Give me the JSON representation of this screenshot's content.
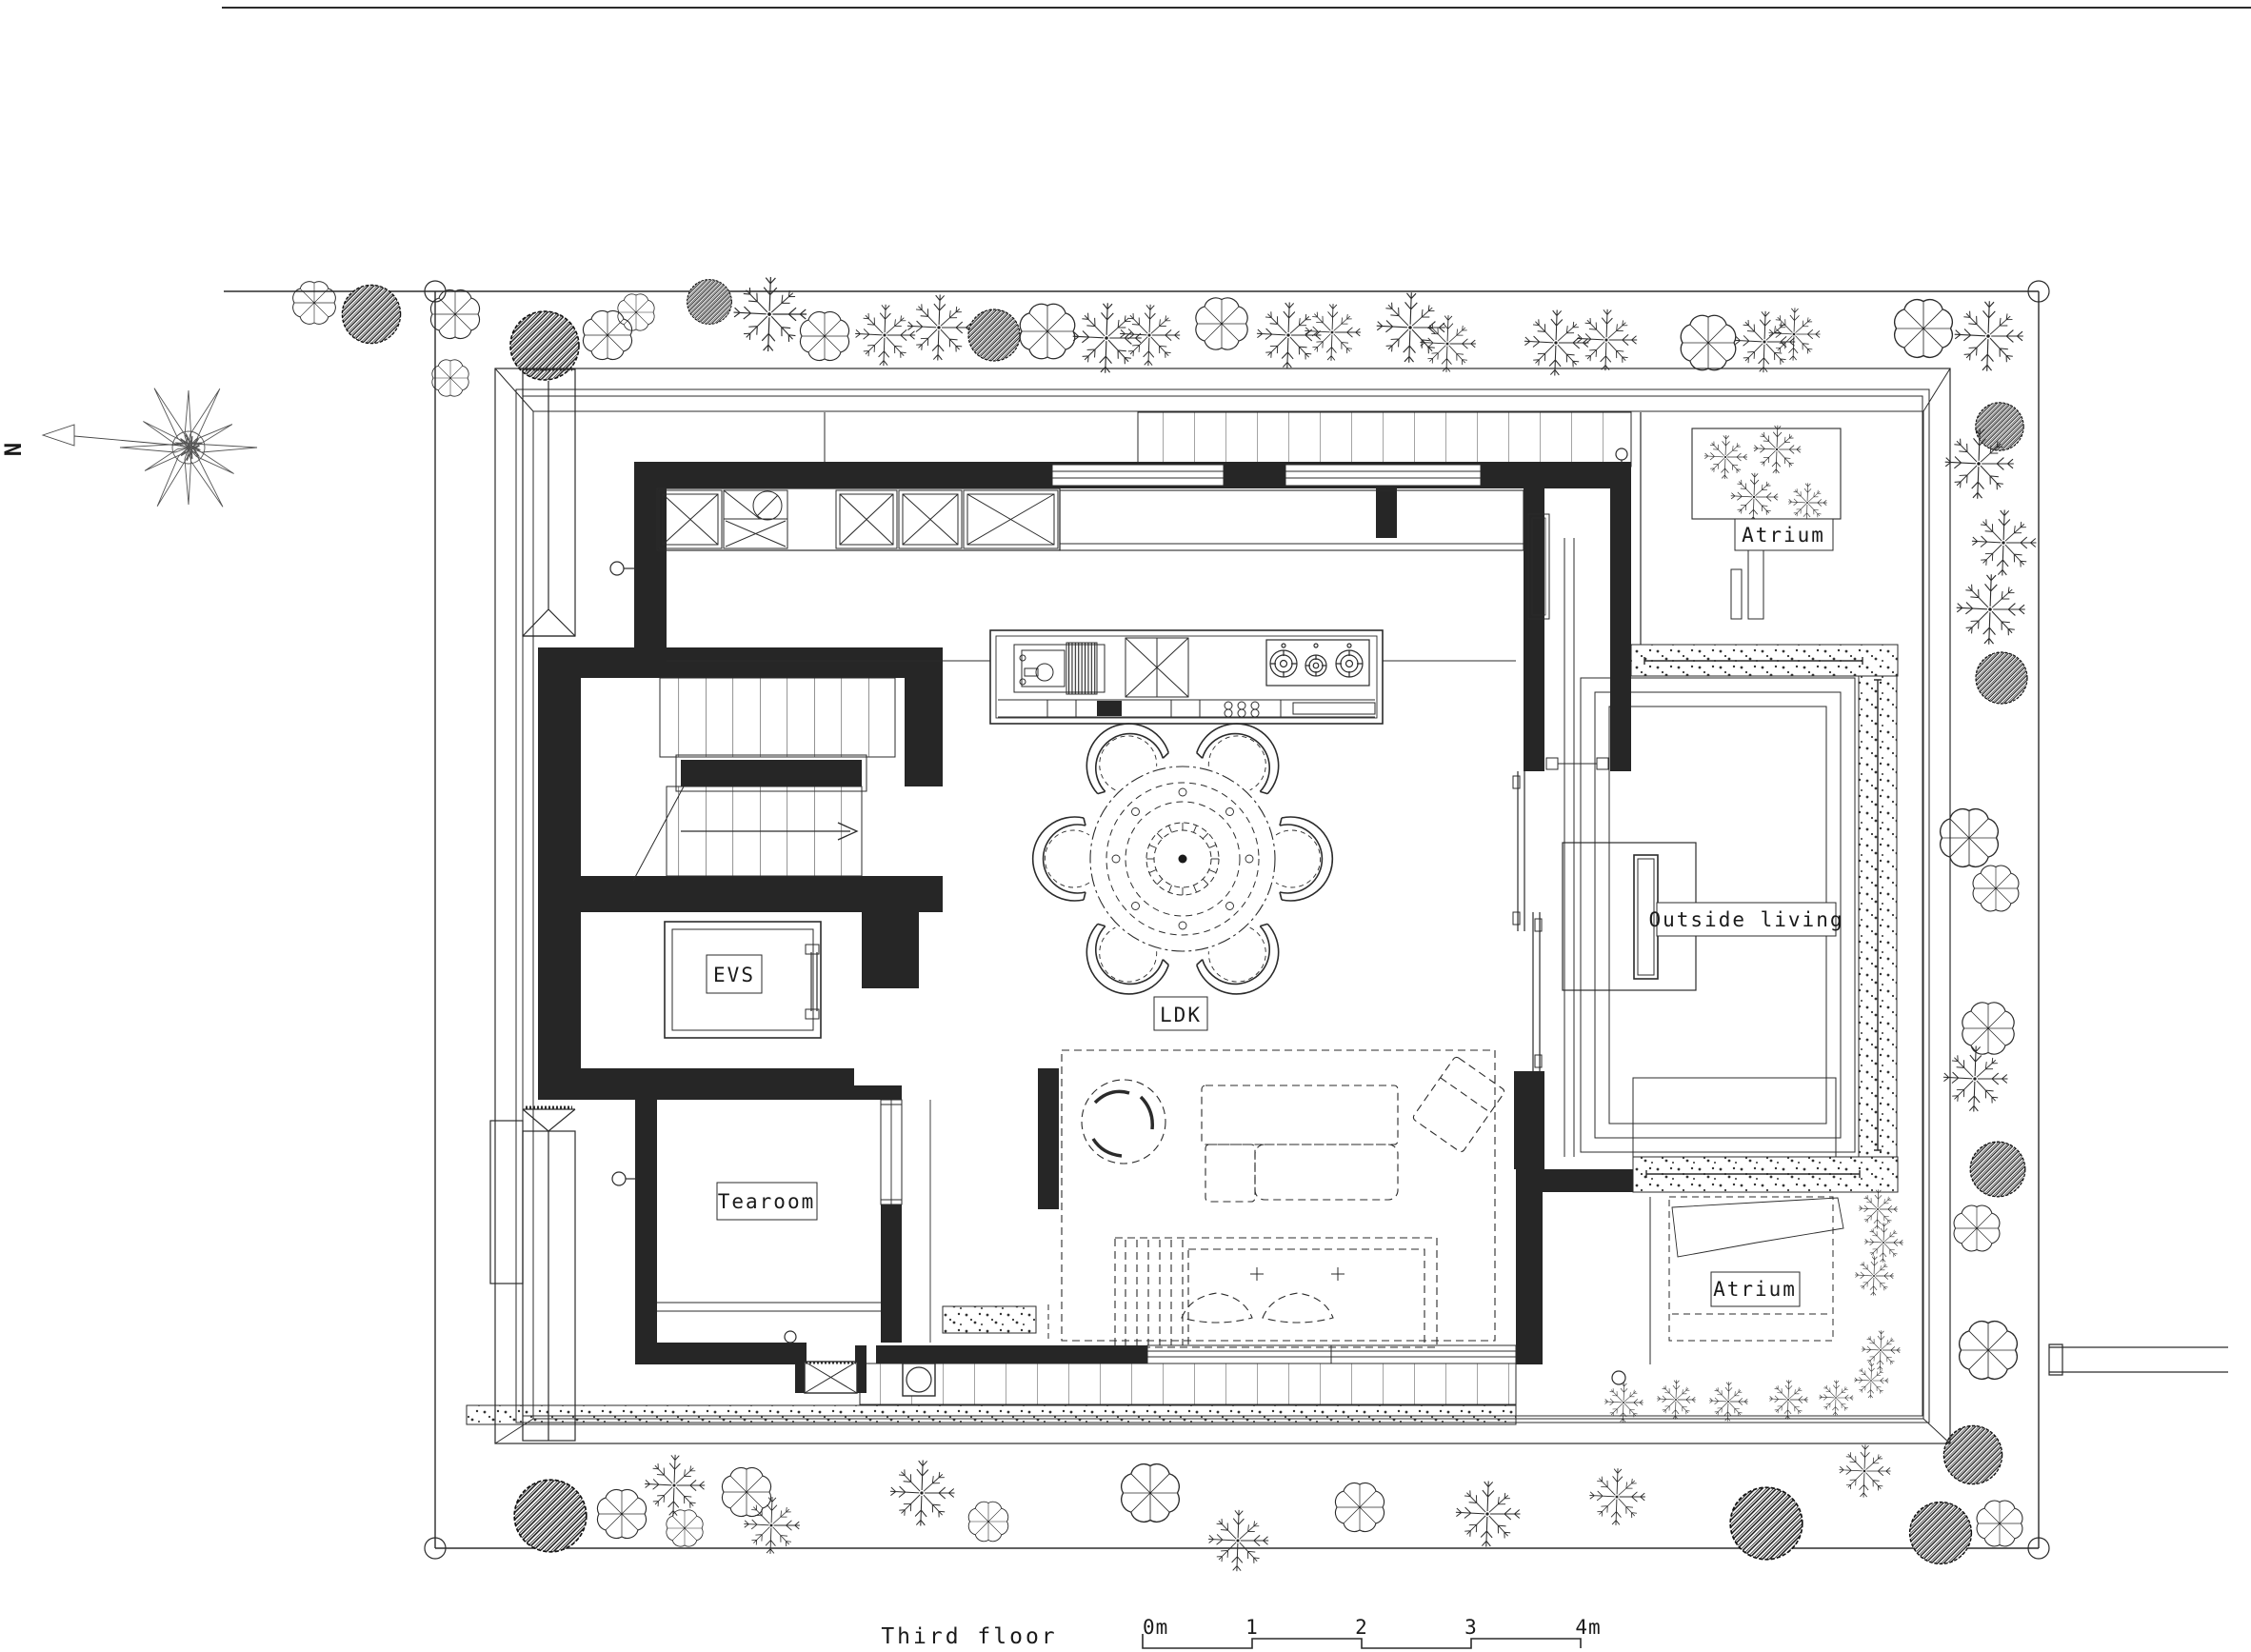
{
  "title": {
    "text": "Third floor"
  },
  "north": {
    "label": "N"
  },
  "rooms": {
    "ldk": "LDK",
    "evs": "EVS",
    "tearoom": "Tearoom",
    "atrium_top": "Atrium",
    "atrium_bottom": "Atrium",
    "outside_living": "Outside living"
  },
  "scalebar": {
    "labels": [
      "0m",
      "1",
      "2",
      "3",
      "4m"
    ]
  },
  "colors": {
    "line": "#2b2b2b",
    "wall_fill": "#262626",
    "background": "#ffffff"
  }
}
